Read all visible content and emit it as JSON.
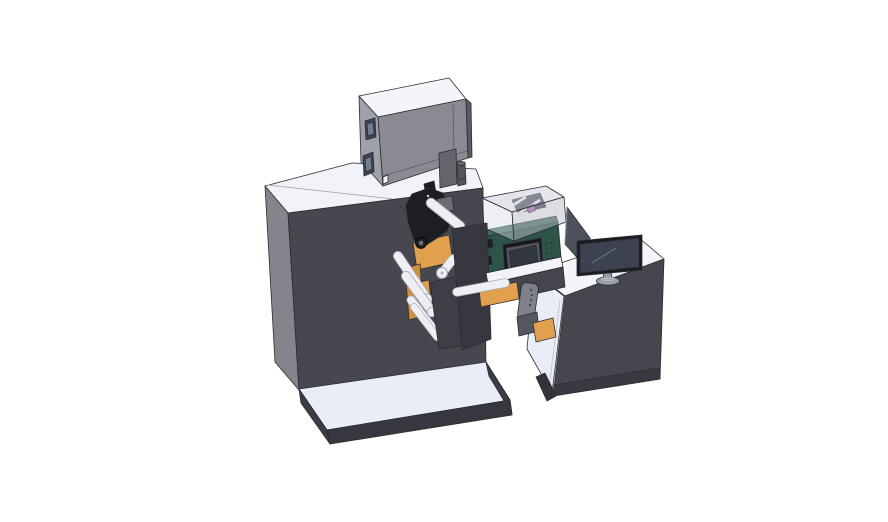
{
  "scene": {
    "description": "3D CAD isometric render of an industrial roll-fed label printing machine with an operator desk and monitor on a white background",
    "background": "#ffffff"
  },
  "components": [
    "main-machine-cabinet",
    "electrical-box",
    "signal-cylinder",
    "rear-panel-slab",
    "print-head-mechanism",
    "web-guide-rollers",
    "orange-label-web",
    "front-cover-plates",
    "printer-module-with-lcd",
    "acrylic-safety-cover",
    "transfer-arm",
    "hand-pendant",
    "operator-desk",
    "desk-monitor",
    "glass-screen-panel",
    "machine-base-plate"
  ],
  "colors": {
    "bg": "#ffffff",
    "top_white": "#f1f3f9",
    "base_top": "#e9edf7",
    "machine_front": "#47474f",
    "machine_left": "#84848c",
    "plate_dark": "#3e3e46",
    "plate_darker": "#37373f",
    "base_edge": "#3c3c44",
    "box_top": "#f4f5f9",
    "box_front": "#8a8a92",
    "box_left": "#9da2aa",
    "box_right": "#5b5b63",
    "slab": "#64646c",
    "cylinder": "#54555d",
    "window_frame": "#3e4656",
    "window_pane": "#707d8e",
    "white_detail": "#f5f6fa",
    "orange": "#e0a04e",
    "orange_dark": "#cf8f41",
    "mech_black": "#1d1e23",
    "mech_gray": "#6a6c74",
    "dot_light": "#c9ccd2",
    "roller": "#edeff5",
    "roller_edge": "#a6aab4",
    "green_top": "#3d6a5b",
    "green_front": "#2e5349",
    "bezel": "#16171c",
    "screen_frame": "#555862",
    "screen": "#33373f",
    "vent": "#1a332c",
    "acrylic": "#c9ceda",
    "acrylic_front": "#d9dde7",
    "acrylic_side": "#b9bec9",
    "acrylic_inside": "#41444c",
    "magenta": "#b25cb2",
    "arm_bar": "#45454d",
    "pendant": "#7f828a",
    "pendant_dot": "#3f4148",
    "bracket": "#55575f",
    "desk_front": "#46464e",
    "kick": "#393941",
    "desk_leg": "#33343b",
    "glass": "#4d515b",
    "monitor_bezel": "#1b1c21",
    "monitor_screen": "#3c4250",
    "monitor_highlight": "#707788",
    "stand": "#989ea9",
    "stand_light": "#aab0ba",
    "wire": "#3a3c42",
    "seam": "#9ca0ab",
    "interior_shade": "#c2c6d2",
    "connector_dark": "#1b1d22"
  }
}
